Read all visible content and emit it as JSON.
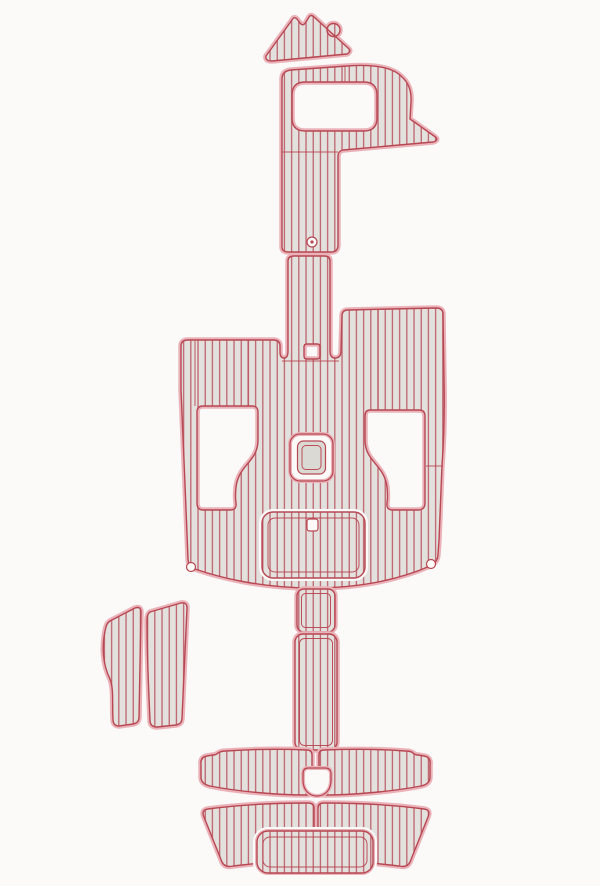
{
  "meta": {
    "title": "EVA foam teak boat decking pad kit",
    "description": "Top-down template layout of a boat swim platform and cockpit EVA foam teak decking pad set; grey pads with red plank stripes and pink cut outlines on a white background",
    "visible_text": "",
    "piece_count": 12
  },
  "colors": {
    "bg": "#fbfaf9",
    "halo": "#eab3ba",
    "line": "#b84752",
    "stripe": "#bd5f6b",
    "padfill": "#e3e1dd",
    "panel": "#dbd9d4"
  },
  "pieces": [
    {
      "id": "bow-wedge-pad",
      "label": "Bow wedge pad with anchor hole"
    },
    {
      "id": "bow-walkway-pad",
      "label": "Bow walkway pad with hatch cutout"
    },
    {
      "id": "cockpit-main-pad",
      "label": "Main cockpit pad with seat cutouts, center hatch and engine panel"
    },
    {
      "id": "step-strip-upper",
      "label": "Upper step strip"
    },
    {
      "id": "step-strip-lower",
      "label": "Lower step strip"
    },
    {
      "id": "side-step-pad-left",
      "label": "Left side step pad (outer)"
    },
    {
      "id": "side-step-pad-right",
      "label": "Left side step pad (inner)"
    },
    {
      "id": "swim-platform-upper-left",
      "label": "Swim platform upper band, left half"
    },
    {
      "id": "swim-platform-upper-right",
      "label": "Swim platform upper band, right half"
    },
    {
      "id": "swim-platform-lower-left",
      "label": "Swim platform lower band, left half"
    },
    {
      "id": "swim-platform-lower-right",
      "label": "Swim platform lower band, right half"
    },
    {
      "id": "swim-platform-center-pad",
      "label": "Swim platform center pad"
    }
  ]
}
